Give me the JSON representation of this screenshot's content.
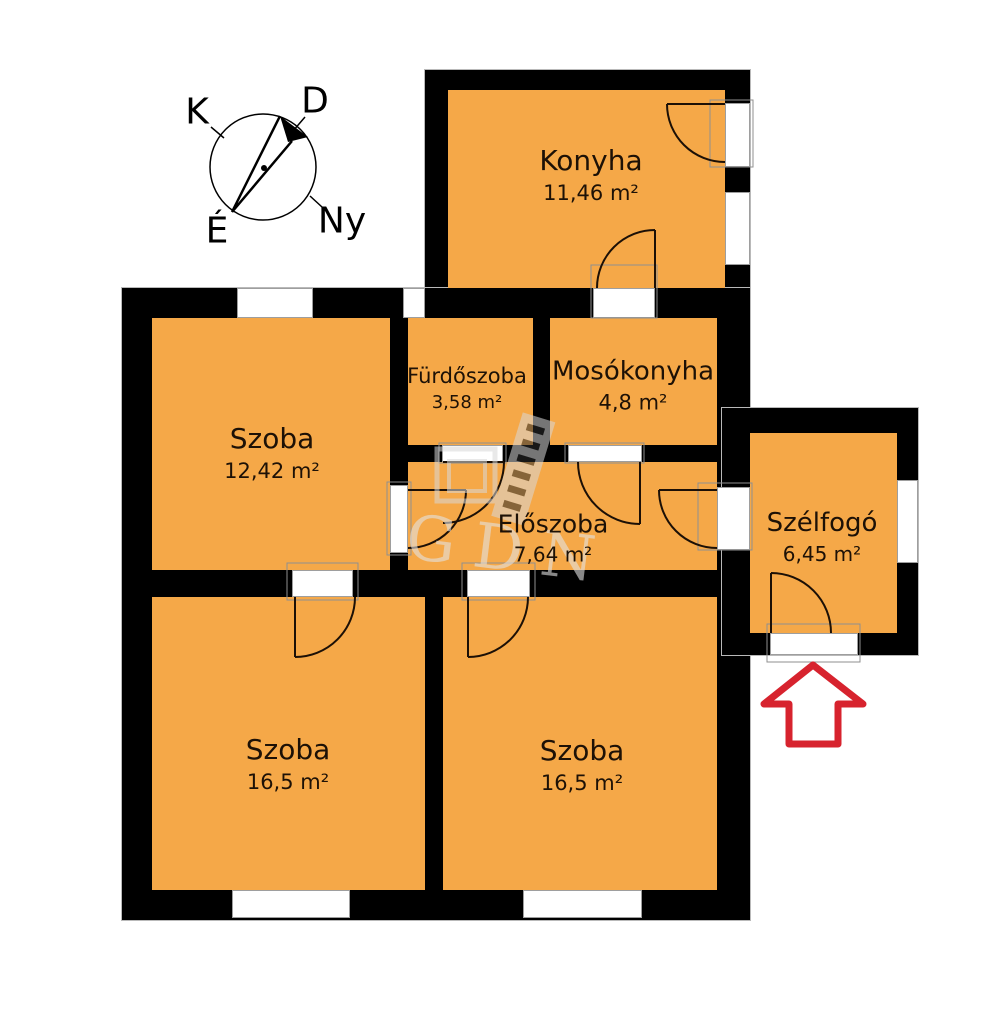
{
  "title": "Lakás alaprajz",
  "colors": {
    "room_fill": "#F5A848",
    "wall": "#000000",
    "entrance_arrow_red": "#D7232E",
    "label_text": "#1D1106",
    "watermark_gray": "#E2E2E2"
  },
  "compass": {
    "east": "K",
    "south": "D",
    "west": "Ny",
    "north": "É"
  },
  "watermark": {
    "text": "GDN"
  },
  "rooms": [
    {
      "id": "konyha",
      "name": "Konyha",
      "area": "11,46 m²"
    },
    {
      "id": "furdoszoba",
      "name": "Fürdőszoba",
      "area": "3,58 m²"
    },
    {
      "id": "mosokonyha",
      "name": "Mosókonyha",
      "area": "4,8 m²"
    },
    {
      "id": "szoba_felso",
      "name": "Szoba",
      "area": "12,42 m²"
    },
    {
      "id": "eloszoba",
      "name": "Előszoba",
      "area": "7,64 m²"
    },
    {
      "id": "szelfogo",
      "name": "Szélfogó",
      "area": "6,45 m²"
    },
    {
      "id": "szoba_bal",
      "name": "Szoba",
      "area": "16,5 m²"
    },
    {
      "id": "szoba_jobb",
      "name": "Szoba",
      "area": "16,5 m²"
    }
  ]
}
